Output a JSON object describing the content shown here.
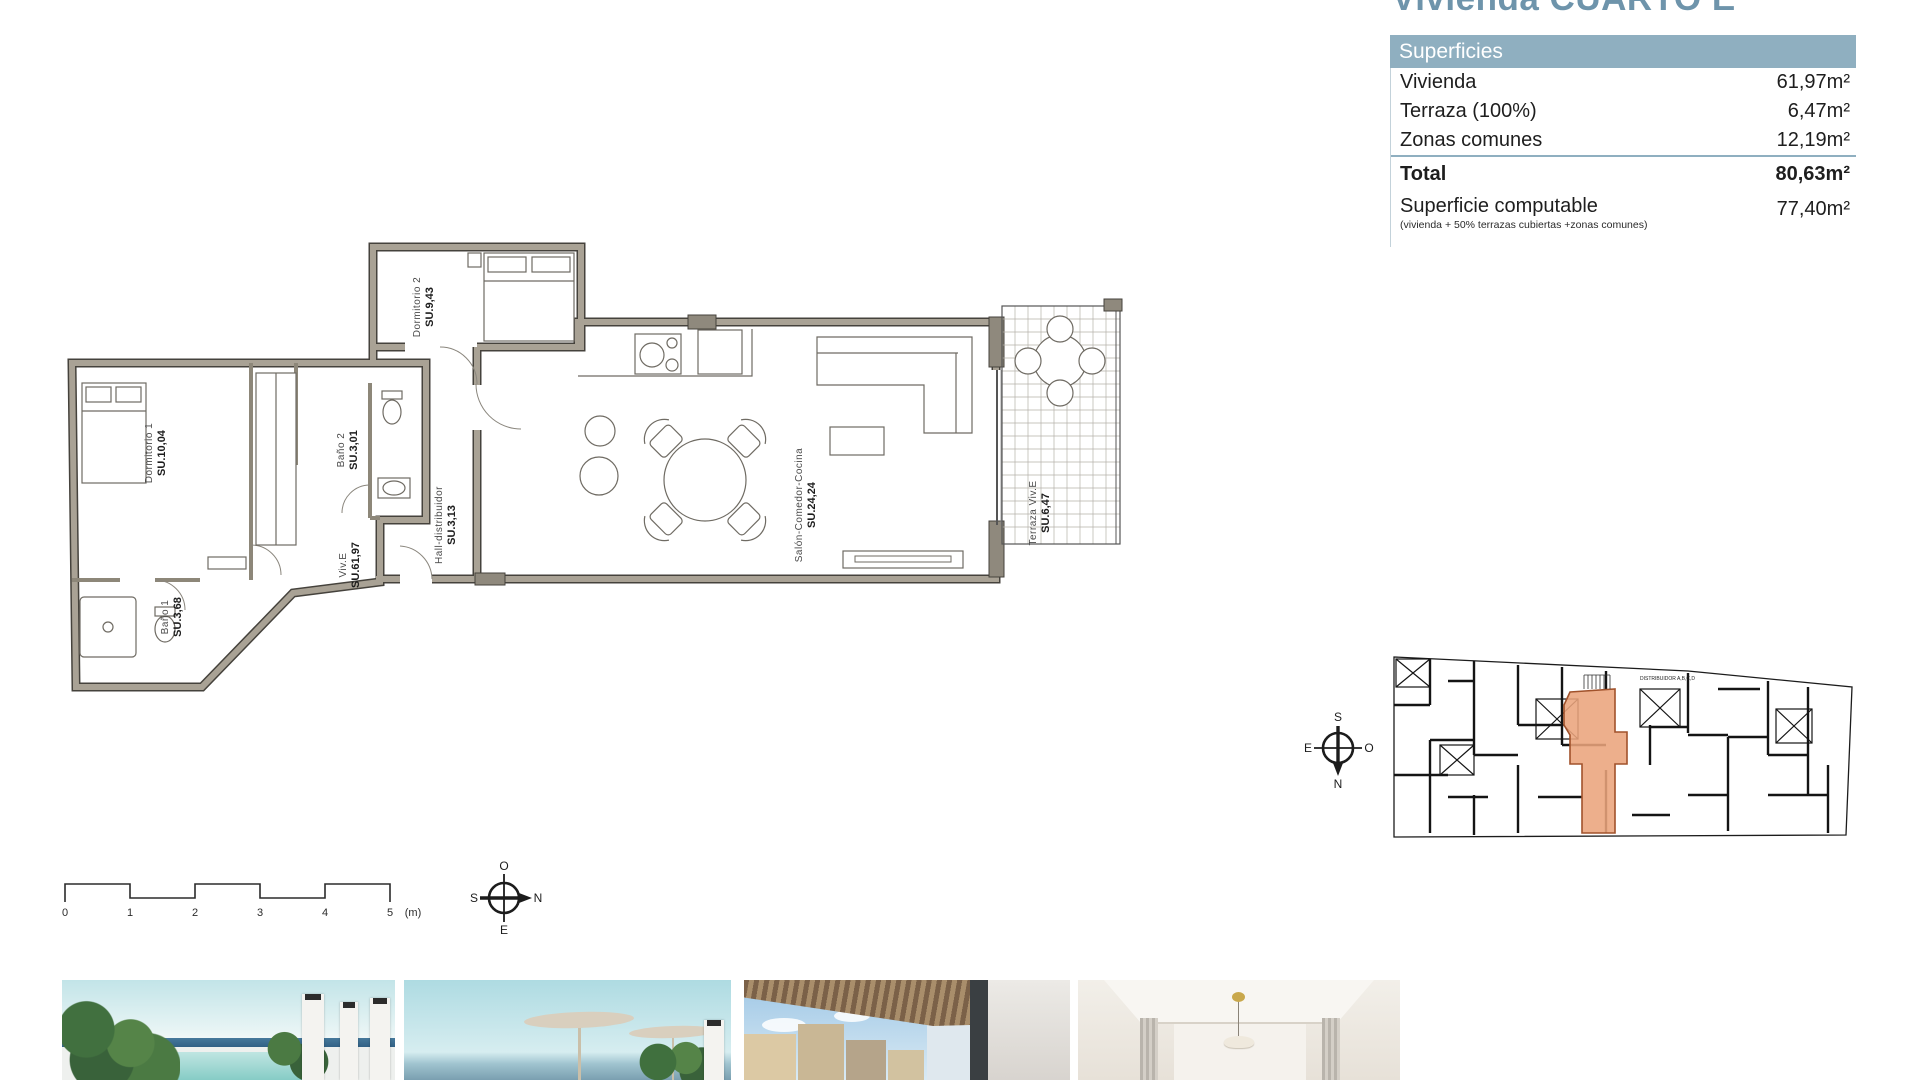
{
  "page": {
    "title": "Vivienda CUARTO E"
  },
  "colors": {
    "accent_blue": "#8fafc0",
    "title_blue": "#6e94ab",
    "wall_gray": "#a9a295",
    "highlight_orange": "#eaa47c"
  },
  "surfaces_table": {
    "header": "Superficies",
    "rows": [
      {
        "label": "Vivienda",
        "value": "61,97m²"
      },
      {
        "label": "Terraza (100%)",
        "value": "6,47m²"
      },
      {
        "label": "Zonas comunes",
        "value": "12,19m²"
      }
    ],
    "total": {
      "label": "Total",
      "value": "80,63m²"
    },
    "computable": {
      "label": "Superficie computable",
      "note": "(vivienda + 50% terrazas cubiertas +zonas comunes)",
      "value": "77,40m²"
    }
  },
  "floor_plan": {
    "rooms": [
      {
        "id": "dormitorio-1",
        "name": "Dormitorio 1",
        "area": "SU.10,04"
      },
      {
        "id": "dormitorio-2",
        "name": "Dormitorio 2",
        "area": "SU.9,43"
      },
      {
        "id": "bano-1",
        "name": "Baño 1",
        "area": "SU.3,68"
      },
      {
        "id": "bano-2",
        "name": "Baño 2",
        "area": "SU.3,01"
      },
      {
        "id": "hall",
        "name": "Hall-distribuidor",
        "area": "SU.3,13"
      },
      {
        "id": "vivienda-e",
        "name": "Viv.E",
        "area": "SU.61,97"
      },
      {
        "id": "salon",
        "name": "Salón-Comedor-Cocina",
        "area": "SU.24,24"
      },
      {
        "id": "terraza",
        "name": "Terraza Viv.E",
        "area": "SU.6,47"
      }
    ]
  },
  "scale_bar": {
    "ticks": [
      "0",
      "1",
      "2",
      "3",
      "4",
      "5"
    ],
    "unit": "(m)"
  },
  "compass_main": {
    "top": "O",
    "left": "S",
    "right": "N",
    "bottom": "E"
  },
  "compass_keyplan": {
    "top": "S",
    "left": "E",
    "right": "O",
    "bottom": "N"
  },
  "key_plan": {
    "annotation": "DISTRIBUIDOR A,B,C,D"
  },
  "photos": [
    {
      "name": "pool-terrace"
    },
    {
      "name": "beach-umbrellas"
    },
    {
      "name": "balcony-city-view"
    },
    {
      "name": "living-room-interior"
    }
  ]
}
